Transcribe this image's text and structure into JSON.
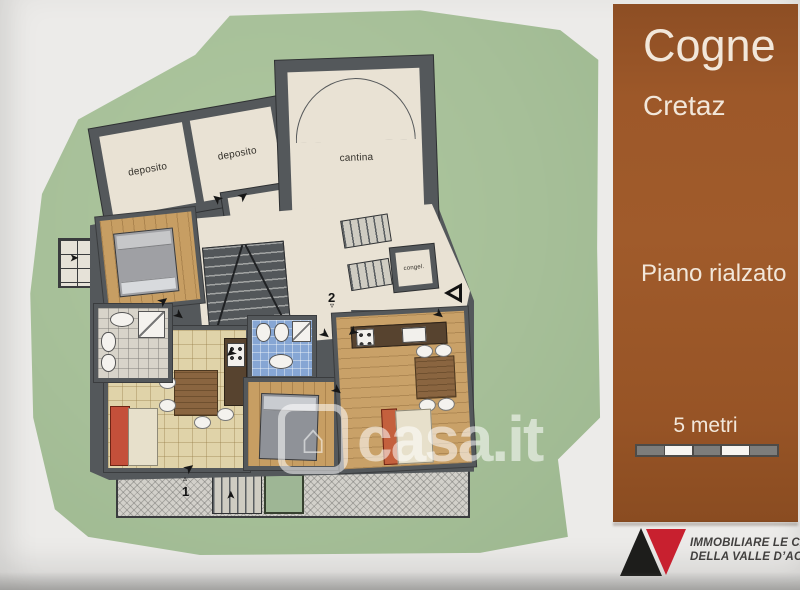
{
  "title_panel": {
    "city": "Cogne",
    "locality": "Cretaz",
    "floor": "Piano rialzato",
    "scale_label": "5 metri"
  },
  "agency": {
    "name_line1": "IMMOBILIARE LE CASE",
    "name_line2": "DELLA VALLE D’AOSTA s.r.l."
  },
  "watermark": {
    "text": "casa.it"
  },
  "icons": {
    "house": "⌂",
    "arrow": "➤",
    "tri_up": "▵",
    "tri_down": "▿"
  },
  "plan": {
    "room_labels": {
      "deposito_left": "deposito",
      "deposito_right": "deposito",
      "cantina": "cantina",
      "closet": "congel."
    },
    "door_numbers": {
      "one": "1",
      "two": "2"
    },
    "colors": {
      "lawn_green": "#a6bf98",
      "wall_gray": "#54585b",
      "floor_cream": "#e9e2d4",
      "floor_wood": "#c79e63",
      "floor_tile": "#e0d3a9",
      "floor_bath": "#d8d4ca",
      "floor_bath_blue": "#86a6d4",
      "sofa_red": "#c4503a",
      "bed_orange": "#c4603d",
      "panel_brown": "#9b5628",
      "logo_black": "#1d1d1b",
      "logo_red": "#c8202f"
    }
  }
}
